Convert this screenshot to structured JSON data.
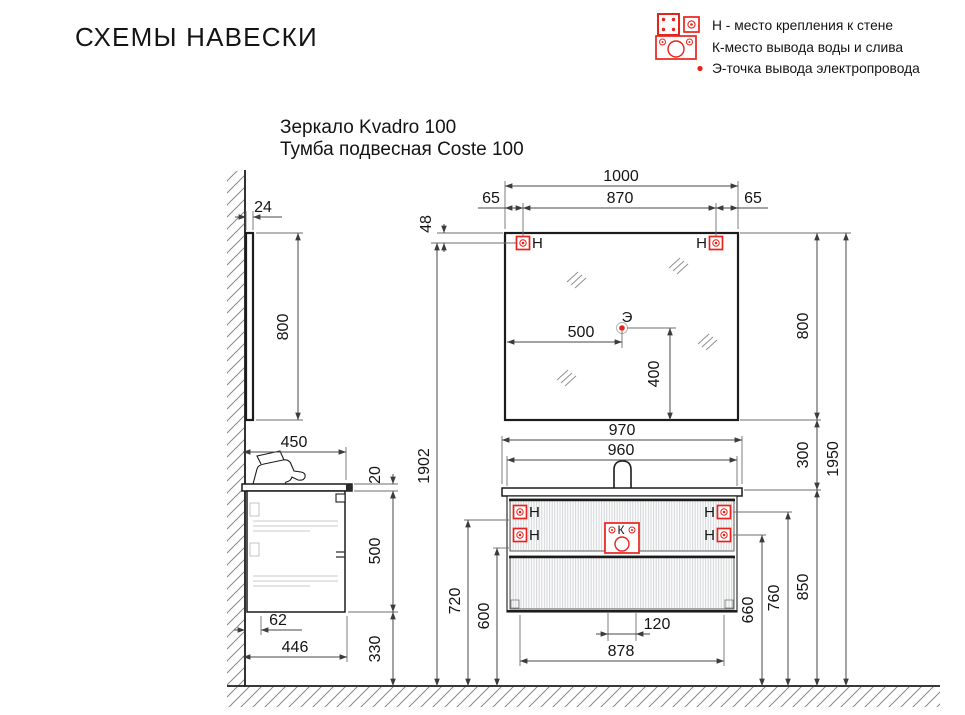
{
  "header": {
    "title": "СХЕМЫ НАВЕСКИ"
  },
  "legend": {
    "mount": "Н - место крепления к стене",
    "water": "К-место вывода воды и слива",
    "electric": "Э-точка вывода электропровода"
  },
  "product": {
    "line1": "Зеркало Kvadro 100",
    "line2": "Тумба подвесная Coste 100"
  },
  "markers": {
    "mount": "Н",
    "water": "К",
    "electric": "Э"
  },
  "side_view": {
    "mirror_thickness": "24",
    "mirror_height": "800",
    "cabinet_depth": "450",
    "countertop_thickness": "20",
    "cabinet_height": "500",
    "wall_offset": "62",
    "body_depth": "446",
    "floor_clearance": "330"
  },
  "front_view": {
    "mirror_width": "1000",
    "mount_offset_left": "65",
    "mount_spacing": "870",
    "mount_offset_right": "65",
    "mount_from_top": "48",
    "mirror_height": "800",
    "electric_from_left": "500",
    "electric_from_bottom": "400",
    "countertop_width": "970",
    "body_width": "960",
    "mirror_gap": "300",
    "total_height": "1950",
    "mirror_mount_height": "1902",
    "rail_height_upper": "720",
    "rail_height_lower": "600",
    "drain_spacing": "120",
    "mount_spacing_cabinet": "878",
    "mount_low_height": "660",
    "mount_high_height": "760",
    "countertop_height": "850"
  },
  "colors": {
    "accent_red": "#e8231d",
    "line": "#1c1c1c",
    "dim_line": "#474747"
  }
}
